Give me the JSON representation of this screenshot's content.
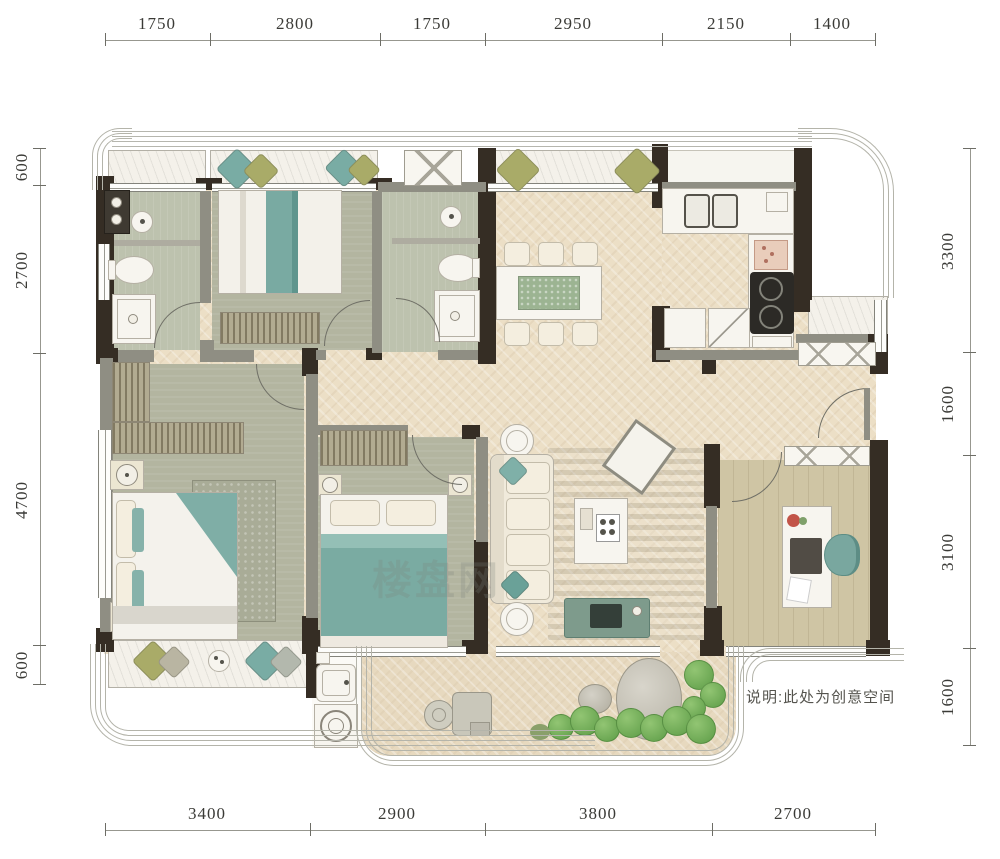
{
  "title": "apartment-floor-plan",
  "dimensions": {
    "top": [
      "1750",
      "2800",
      "1750",
      "2950",
      "2150",
      "1400"
    ],
    "bottom": [
      "3400",
      "2900",
      "3800",
      "2700"
    ],
    "left": [
      "600",
      "2700",
      "4700",
      "600"
    ],
    "right": [
      "3300",
      "1600",
      "3100",
      "1600"
    ]
  },
  "note": {
    "text": "说明:此处为创意空间"
  },
  "watermark": {
    "text": "楼盘网"
  },
  "colors": {
    "wall_dark": "#352d24",
    "wall_grey": "#8f8e83",
    "floor_cream": "#ecdfc6",
    "floor_bedroom": "#b3b5a0",
    "floor_bath": "#bdc2ae",
    "floor_wood": "#cfc5a4",
    "marble": "#f4f1ea",
    "accent_teal": "#7fb0a8",
    "accent_olive": "#a9ab68",
    "plant_green": "#5d9c47"
  }
}
